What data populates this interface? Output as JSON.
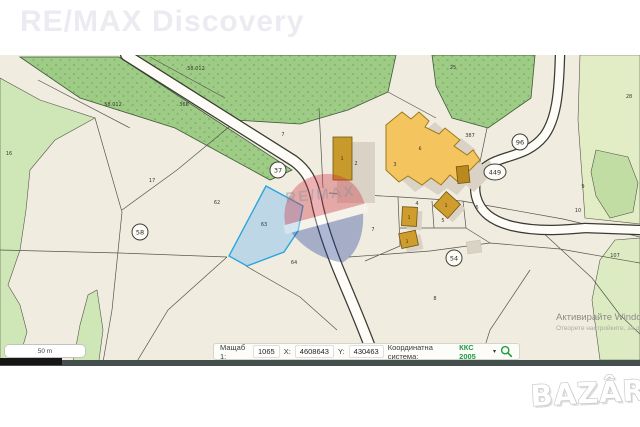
{
  "header": {
    "watermark": "RE/MAX Discovery"
  },
  "footer": {
    "bazar_logo": "BAZÂR"
  },
  "windows_watermark": {
    "line1": "Активирайте Windows",
    "line2": "Отворете настройките, за да активирате Windows"
  },
  "scalebar": {
    "label": "50 m"
  },
  "toolbar": {
    "scale_label": "Мащаб 1:",
    "scale_value": "1065",
    "x_label": "X:",
    "x_value": "4608643",
    "y_label": "Y:",
    "y_value": "430463",
    "crs_label": "Координатна система:",
    "crs_value": "ККС 2005"
  },
  "colors": {
    "crs_green": "#1e9e3e",
    "selected_parcel_fill": "#aed0ea",
    "selected_parcel_stroke": "#2aa6dd",
    "building_orange": "#f4c45f",
    "building_ochre": "#c8992b",
    "forest_green": "#9ecb85",
    "meadow_green": "#cfe6b6",
    "map_beige": "#f0ecdf"
  },
  "map": {
    "selected_parcel": {
      "id": "63"
    },
    "road_badges": [
      {
        "label": "37",
        "cx": 278,
        "cy": 170,
        "rx": 8
      },
      {
        "label": "58",
        "cx": 140,
        "cy": 232,
        "rx": 8
      },
      {
        "label": "96",
        "cx": 520,
        "cy": 142,
        "rx": 8
      },
      {
        "label": "449",
        "cx": 495,
        "cy": 172,
        "rx": 11
      },
      {
        "label": "54",
        "cx": 454,
        "cy": 258,
        "rx": 8
      }
    ],
    "labels": [
      {
        "text": "58.012",
        "x": 196,
        "y": 70
      },
      {
        "text": "58.012",
        "x": 113,
        "y": 106
      },
      {
        "text": "368",
        "x": 184,
        "y": 106
      },
      {
        "text": "25",
        "x": 453,
        "y": 69
      },
      {
        "text": "28",
        "x": 629,
        "y": 98
      },
      {
        "text": "16",
        "x": 9,
        "y": 155
      },
      {
        "text": "17",
        "x": 152,
        "y": 182
      },
      {
        "text": "62",
        "x": 217,
        "y": 204
      },
      {
        "text": "63",
        "x": 264,
        "y": 226,
        "cls": "sel"
      },
      {
        "text": "64",
        "x": 294,
        "y": 264
      },
      {
        "text": "7",
        "x": 283,
        "y": 136
      },
      {
        "text": "3",
        "x": 395,
        "y": 166
      },
      {
        "text": "387",
        "x": 470,
        "y": 137
      },
      {
        "text": "6",
        "x": 420,
        "y": 150,
        "cls": "bld"
      },
      {
        "text": "1",
        "x": 342,
        "y": 160,
        "cls": "bld"
      },
      {
        "text": "2",
        "x": 356,
        "y": 165
      },
      {
        "text": "4",
        "x": 417,
        "y": 205
      },
      {
        "text": "1",
        "x": 409,
        "y": 219,
        "cls": "bld"
      },
      {
        "text": "1",
        "x": 446,
        "y": 207,
        "cls": "bld"
      },
      {
        "text": "5",
        "x": 443,
        "y": 222
      },
      {
        "text": "6",
        "x": 477,
        "y": 209
      },
      {
        "text": "7",
        "x": 373,
        "y": 231
      },
      {
        "text": "1",
        "x": 407,
        "y": 243,
        "cls": "bld"
      },
      {
        "text": "8",
        "x": 435,
        "y": 300
      },
      {
        "text": "9",
        "x": 583,
        "y": 188
      },
      {
        "text": "10",
        "x": 578,
        "y": 212
      },
      {
        "text": "107",
        "x": 615,
        "y": 257
      }
    ]
  }
}
